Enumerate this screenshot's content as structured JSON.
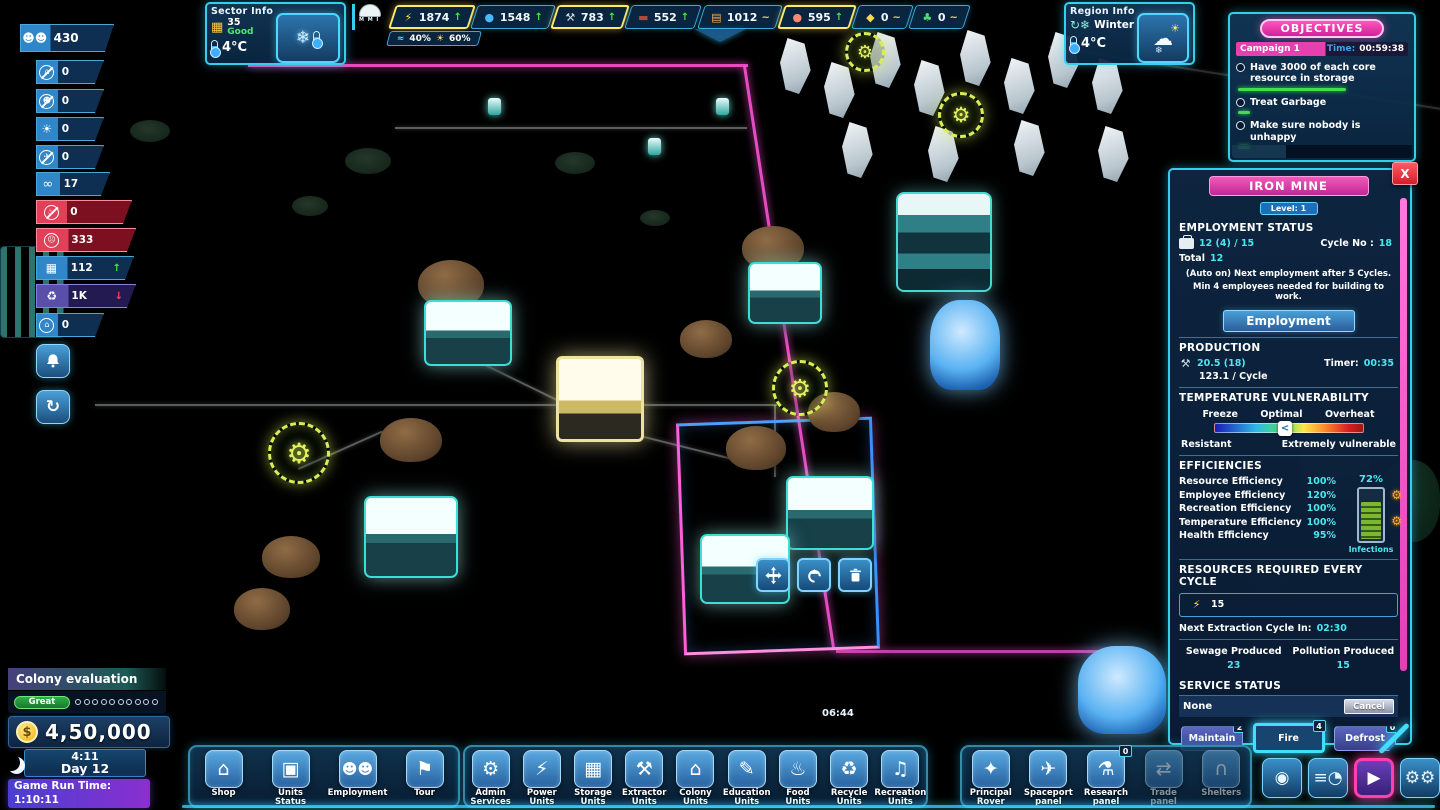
{
  "colors": {
    "accent_cyan": "#36cfe9",
    "accent_pink": "#ff3fd0",
    "panel_blue": "#12375a",
    "teal_value": "#49e8ef",
    "good_green": "#3fdf4f",
    "alert_red": "#e83040",
    "warn_yellow": "#ffe86a"
  },
  "sector_info": {
    "title": "Sector Info",
    "score": "35",
    "rating": "Good",
    "temperature": "4°C"
  },
  "resource_bar": {
    "mmi_label": "M M I",
    "resources": [
      {
        "name": "power",
        "icon": "power-icon",
        "value": "1874",
        "trend_char": "↑"
      },
      {
        "name": "water",
        "icon": "water-icon",
        "value": "1548",
        "trend_char": "↑"
      },
      {
        "name": "iron",
        "icon": "iron-icon",
        "value": "783",
        "trend_char": "↑"
      },
      {
        "name": "clay",
        "icon": "clay-icon",
        "value": "552",
        "trend_char": "↑"
      },
      {
        "name": "food",
        "icon": "food-icon",
        "value": "1012",
        "trend_char": "~"
      },
      {
        "name": "meat",
        "icon": "meat-icon",
        "value": "595",
        "trend_char": "↑"
      },
      {
        "name": "gold",
        "icon": "gold-icon",
        "value": "0",
        "trend_char": "~"
      },
      {
        "name": "luck",
        "icon": "clover-icon",
        "value": "0",
        "trend_char": "~"
      }
    ],
    "humidity": "40%",
    "sunlight": "60%"
  },
  "region_info": {
    "title": "Region Info",
    "season": "Winter",
    "temperature": "4°C"
  },
  "objectives": {
    "title": "OBJECTIVES",
    "campaign": "Campaign 1",
    "time_label": "Time:",
    "time_value": "00:59:38",
    "items": [
      {
        "text": "Have 3000 of each core resource in storage"
      },
      {
        "text": "Treat Garbage"
      },
      {
        "text": "Make sure nobody is unhappy"
      }
    ]
  },
  "left_stats": {
    "items": [
      {
        "icon": "population-icon",
        "value": "430"
      },
      {
        "icon": "no-home-icon",
        "value": "0"
      },
      {
        "icon": "no-person-icon",
        "value": "0"
      },
      {
        "icon": "infection-icon",
        "value": "0"
      },
      {
        "icon": "no-transport-icon",
        "value": "0"
      },
      {
        "icon": "binoculars-icon",
        "value": "17"
      },
      {
        "icon": "no-food-icon",
        "value": "0"
      },
      {
        "icon": "unhappy-icon",
        "value": "333"
      },
      {
        "icon": "buildings-icon",
        "value": "112",
        "trend_char": "↑"
      },
      {
        "icon": "garbage-icon",
        "value": "1K",
        "trend_char": "↓"
      },
      {
        "icon": "locked-home-icon",
        "value": "0"
      }
    ]
  },
  "iron_mine": {
    "title": "IRON MINE",
    "close": "X",
    "level": "Level: 1",
    "employment": {
      "heading": "EMPLOYMENT STATUS",
      "current": "12 (4) / 15",
      "cycle_label": "Cycle No :",
      "cycle_value": "18",
      "total_label": "Total",
      "total_value": "12",
      "note1": "(Auto on) Next employment after 5 Cycles.",
      "note2": "Min 4 employees needed for building to work.",
      "button": "Employment"
    },
    "production": {
      "heading": "PRODUCTION",
      "amount": "20.5 (18)",
      "timer_label": "Timer:",
      "timer_value": "00:35",
      "per_cycle": "123.1 / Cycle"
    },
    "temperature": {
      "heading": "TEMPERATURE VULNERABILITY",
      "label_freeze": "Freeze",
      "label_optimal": "Optimal",
      "label_overheat": "Overheat",
      "slider_char": "<",
      "footer_left": "Resistant",
      "footer_right": "Extremely vulnerable"
    },
    "efficiencies": {
      "heading": "EFFICIENCIES",
      "gauge_value": "72%",
      "gauge_label": "Infections",
      "rows": [
        {
          "label": "Resource Efficiency",
          "value": "100%"
        },
        {
          "label": "Employee Efficiency",
          "value": "120%"
        },
        {
          "label": "Recreation Efficiency",
          "value": "100%"
        },
        {
          "label": "Temperature Efficiency",
          "value": "100%"
        },
        {
          "label": "Health Efficiency",
          "value": "95%"
        }
      ]
    },
    "resources_required": {
      "heading": "RESOURCES REQUIRED EVERY CYCLE",
      "power_cost": "15",
      "next_label": "Next Extraction Cycle In:",
      "next_value": "02:30",
      "sewage_label": "Sewage Produced",
      "sewage_value": "23",
      "pollution_label": "Pollution Produced",
      "pollution_value": "15"
    },
    "service": {
      "heading": "SERVICE STATUS",
      "status": "None",
      "cancel": "Cancel",
      "buttons": [
        {
          "label": "Maintain",
          "badge": "2"
        },
        {
          "label": "Fire",
          "badge": "4"
        },
        {
          "label": "Defrost",
          "badge": "0"
        }
      ]
    }
  },
  "colony": {
    "title": "Colony evaluation",
    "rating": "Great",
    "currency": "$",
    "money": "4,50,000",
    "clock_time": "4:11",
    "day": "Day 12",
    "runtime_label": "Game Run Time:",
    "runtime_value": "1:10:11"
  },
  "world": {
    "timer": "06:44"
  },
  "context_toolbar": {
    "buttons": [
      {
        "icon": "move-icon"
      },
      {
        "icon": "upgrade-icon"
      },
      {
        "icon": "delete-icon"
      }
    ]
  },
  "toolbar": {
    "groups": [
      {
        "items": [
          {
            "label": "Shop"
          },
          {
            "label": "Units Status"
          },
          {
            "label": "Employment"
          },
          {
            "label": "Tour"
          }
        ]
      },
      {
        "items": [
          {
            "label": "Admin Services"
          },
          {
            "label": "Power Units"
          },
          {
            "label": "Storage Units"
          },
          {
            "label": "Extractor Units"
          },
          {
            "label": "Colony Units"
          },
          {
            "label": "Education Units"
          },
          {
            "label": "Food Units"
          },
          {
            "label": "Recycle Units"
          },
          {
            "label": "Recreation Units"
          }
        ]
      },
      {
        "items": [
          {
            "label": "Principal Rover"
          },
          {
            "label": "Spaceport panel"
          },
          {
            "label": "Research panel",
            "badge": "0"
          },
          {
            "label": "Trade panel"
          },
          {
            "label": "Shelters"
          }
        ]
      }
    ]
  }
}
